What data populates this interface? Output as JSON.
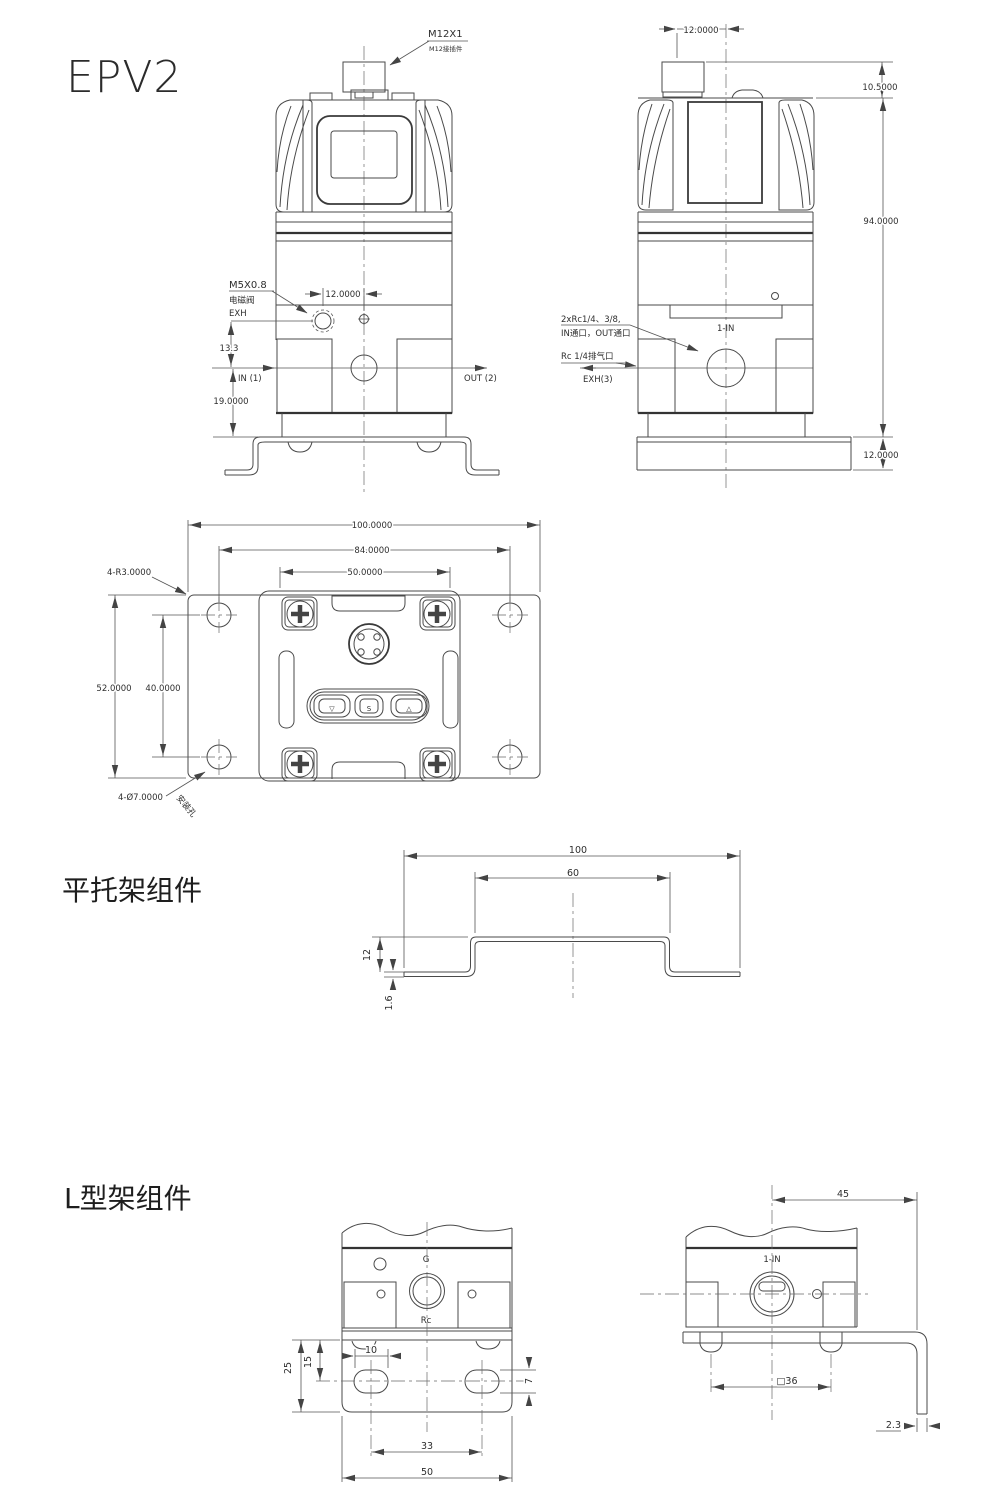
{
  "title": "EPV2",
  "front_view": {
    "connector_label": "M12X1",
    "connector_note": "M12接插件",
    "solenoid_thread": "M5X0.8",
    "solenoid_name": "电磁阀",
    "exh_label": "EXH",
    "dim_12": "12.0000",
    "dim_13_3": "13.3",
    "dim_19": "19.0000",
    "port_in": "IN (1)",
    "port_out": "OUT (2)"
  },
  "side_view": {
    "dim_12_top": "12.0000",
    "dim_10_5": "10.5000",
    "dim_94": "94.0000",
    "dim_12_bottom": "12.0000",
    "port_note_1": "2xRc1/4、3/8,",
    "port_note_2": "IN通口，OUT通口",
    "exhaust_note": "Rc 1/4排气口",
    "exh_port": "EXH(3)",
    "in_label": "1-IN"
  },
  "top_view": {
    "dim_100": "100.0000",
    "dim_84": "84.0000",
    "dim_50": "50.0000",
    "corner_note": "4-R3.0000",
    "dim_52": "52.0000",
    "dim_40": "40.0000",
    "hole_note": "4-Ø7.0000",
    "hole_note_2": "安装孔",
    "btn_down": "▽",
    "btn_set": "S",
    "btn_up": "△"
  },
  "flat_bracket": {
    "section_title": "平托架组件",
    "dim_100": "100",
    "dim_60": "60",
    "dim_12": "12",
    "dim_1_6": "1.6"
  },
  "l_bracket": {
    "section_title": "L型架组件",
    "label_g": "G",
    "label_rc": "Rc",
    "dim_25": "25",
    "dim_15": "15",
    "dim_10": "10",
    "dim_7": "7",
    "dim_33": "33",
    "dim_50": "50",
    "in_label": "1-IN",
    "dim_45": "45",
    "dim_36": "□36",
    "dim_2_3": "2.3"
  }
}
